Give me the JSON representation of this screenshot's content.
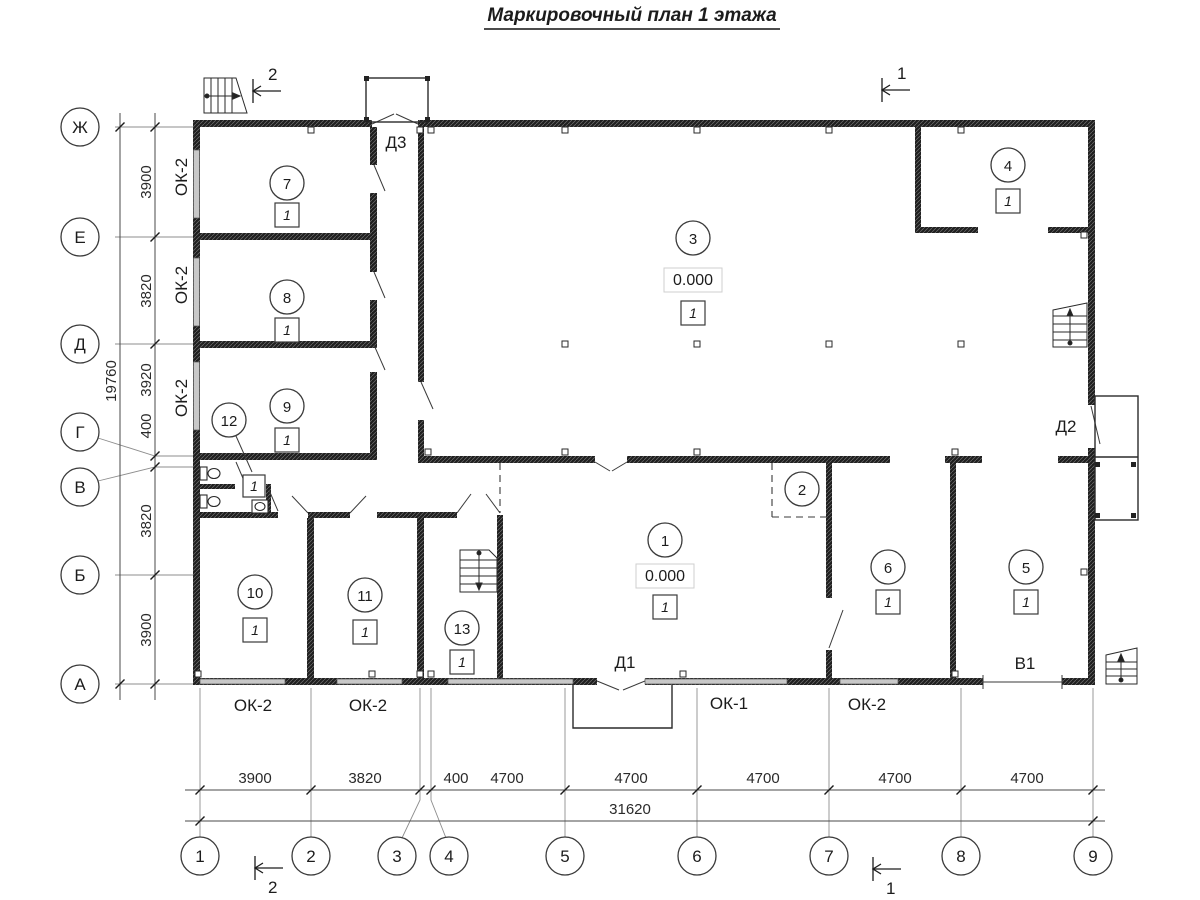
{
  "title": "Маркировочный план 1 этажа",
  "axes": {
    "rows": [
      "Ж",
      "Е",
      "Д",
      "Г",
      "В",
      "Б",
      "А"
    ],
    "cols": [
      "1",
      "2",
      "3",
      "4",
      "5",
      "6",
      "7",
      "8",
      "9"
    ]
  },
  "dims": {
    "v": [
      "3900",
      "3820",
      "3920",
      "400",
      "3820",
      "3900"
    ],
    "v_total": "19760",
    "h": [
      "3900",
      "3820",
      "400",
      "4700",
      "4700",
      "4700",
      "4700",
      "4700"
    ],
    "h_total": "31620"
  },
  "rooms": {
    "r1": {
      "num": "1",
      "elev": "0.000",
      "mark": "1"
    },
    "r2": {
      "num": "2"
    },
    "r3": {
      "num": "3",
      "elev": "0.000",
      "mark": "1"
    },
    "r4": {
      "num": "4",
      "mark": "1"
    },
    "r5": {
      "num": "5",
      "mark": "1"
    },
    "r6": {
      "num": "6",
      "mark": "1"
    },
    "r7": {
      "num": "7",
      "mark": "1"
    },
    "r8": {
      "num": "8",
      "mark": "1"
    },
    "r9": {
      "num": "9",
      "mark": "1"
    },
    "r10": {
      "num": "10",
      "mark": "1"
    },
    "r11": {
      "num": "11",
      "mark": "1"
    },
    "r12": {
      "num": "12",
      "mark": "1"
    },
    "r13": {
      "num": "13",
      "mark": "1"
    }
  },
  "openings": {
    "d1": "Д1",
    "d2": "Д2",
    "d3": "Д3",
    "v1": "В1"
  },
  "win_left": [
    "ОК-2",
    "ОК-2",
    "ОК-2"
  ],
  "win_bottom": [
    "ОК-2",
    "ОК-2",
    "ОК-1",
    "ОК-2"
  ],
  "sections": {
    "s1": "1",
    "s2": "2"
  }
}
